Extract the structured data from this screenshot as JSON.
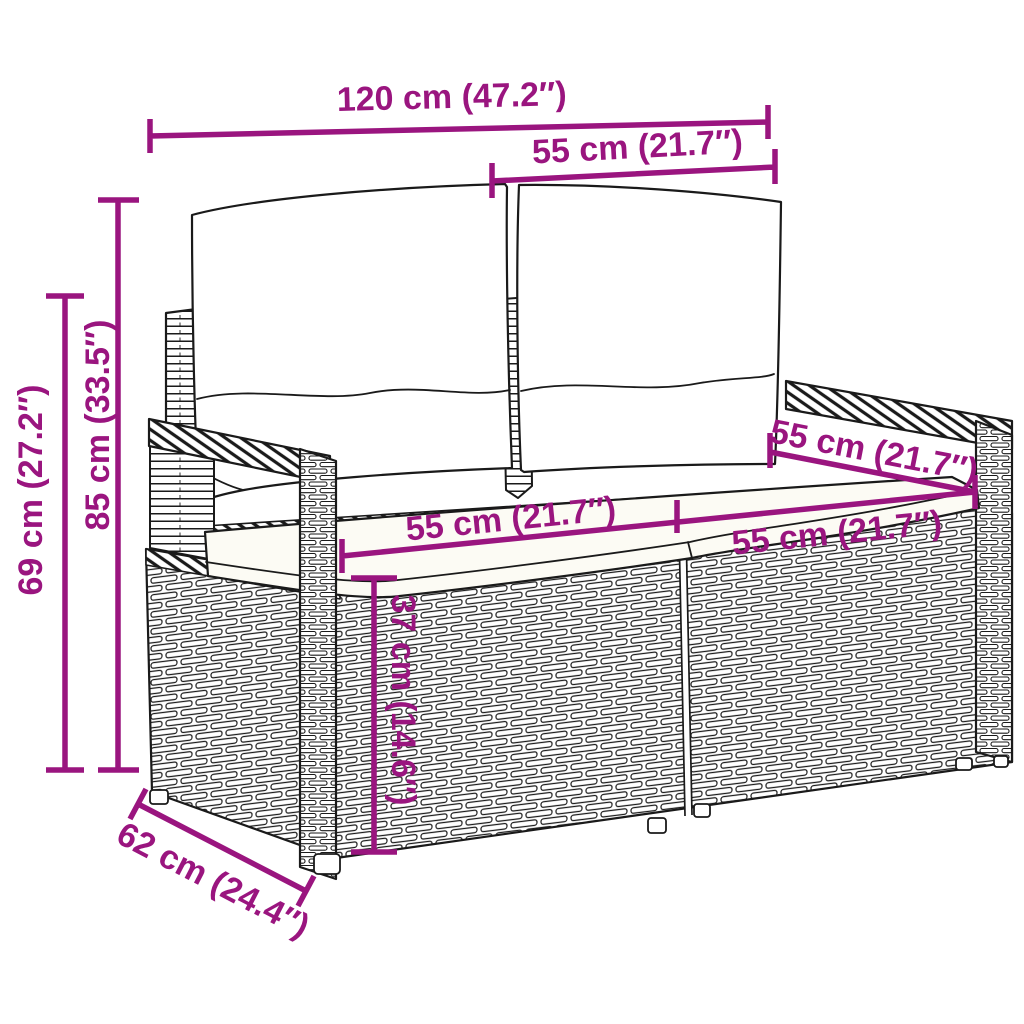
{
  "image": {
    "type": "product dimension diagram",
    "subject": "poly rattan 2-seater garden sofa (loveseat) with back and seat cushions, black line art on white",
    "background_color": "#FFFFFF",
    "annotation_color": "#9A157F",
    "drawing_color": "#1A1A1A",
    "cushion_color": "#FFFFFF",
    "seat_cushion_color": "#FCFBF4"
  },
  "dimensions": {
    "overall_width": "120 cm (47.2″)",
    "backrest_width": "55 cm (21.7″)",
    "overall_height": "85 cm (33.5″)",
    "armrest_height": "69 cm (27.2″)",
    "seat_depth": "55 cm (21.7″)",
    "seat_width_left": "55 cm (21.7″)",
    "seat_width_right": "55 cm (21.7″)",
    "seat_height": "37 cm (14.6″)",
    "overall_depth": "62 cm (24.4″)"
  }
}
